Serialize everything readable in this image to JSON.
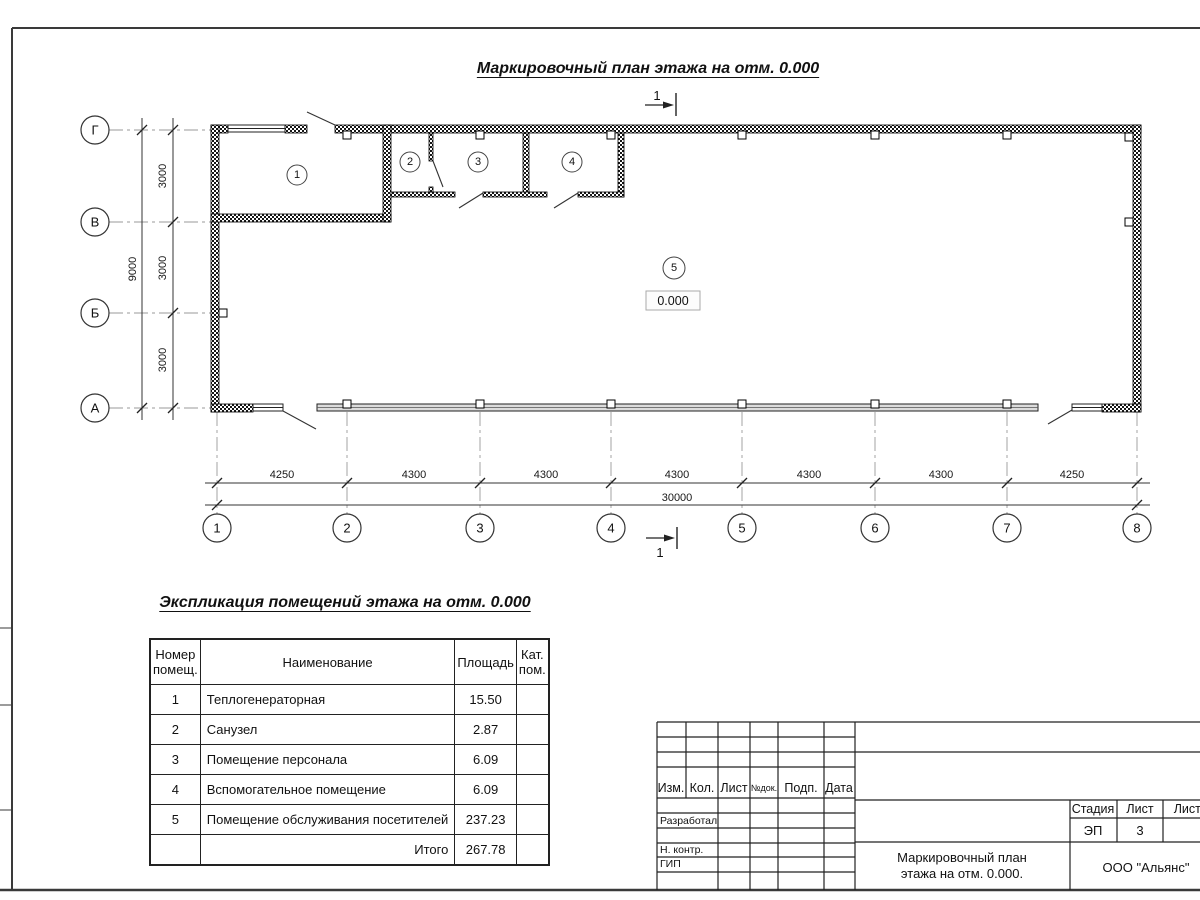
{
  "titles": {
    "plan": "Маркировочный план этажа на отм. 0.000",
    "explication": "Экспликация помещений этажа на отм. 0.000"
  },
  "plan": {
    "elevation": "0.000",
    "section_mark": "1",
    "axes_vertical": [
      "Г",
      "В",
      "Б",
      "А"
    ],
    "axes_horizontal": [
      "1",
      "2",
      "3",
      "4",
      "5",
      "6",
      "7",
      "8"
    ],
    "dims_horizontal": [
      "4250",
      "4300",
      "4300",
      "4300",
      "4300",
      "4300",
      "4250"
    ],
    "dim_horizontal_total": "30000",
    "dims_vertical": [
      "3000",
      "3000",
      "3000"
    ],
    "dim_vertical_total": "9000"
  },
  "rooms": [
    {
      "num": "1",
      "name": "Теплогенераторная",
      "area": "15.50",
      "cat": ""
    },
    {
      "num": "2",
      "name": "Санузел",
      "area": "2.87",
      "cat": ""
    },
    {
      "num": "3",
      "name": "Помещение персонала",
      "area": "6.09",
      "cat": ""
    },
    {
      "num": "4",
      "name": "Вспомогательное помещение",
      "area": "6.09",
      "cat": ""
    },
    {
      "num": "5",
      "name": "Помещение обслуживания посетителей",
      "area": "237.23",
      "cat": ""
    }
  ],
  "explication": {
    "headers": {
      "col1_line1": "Номер",
      "col1_line2": "помещ.",
      "col2": "Наименование",
      "col3": "Площадь",
      "col4_line1": "Кат.",
      "col4_line2": "пом."
    },
    "total_label": "Итого",
    "total_area": "267.78"
  },
  "title_block": {
    "cols": [
      "Изм.",
      "Кол.",
      "Лист",
      "№док.",
      "Подп.",
      "Дата"
    ],
    "rows": {
      "developed": "Разработал",
      "ncontr": "Н. контр.",
      "gip": "ГИП"
    },
    "stage_label": "Стадия",
    "sheet_label": "Лист",
    "sheets_label": "Листов",
    "stage": "ЭП",
    "sheet": "3",
    "doc_title_line1": "Маркировочный план",
    "doc_title_line2": "этажа на отм. 0.000.",
    "company": "ООО \"Альянс\""
  }
}
